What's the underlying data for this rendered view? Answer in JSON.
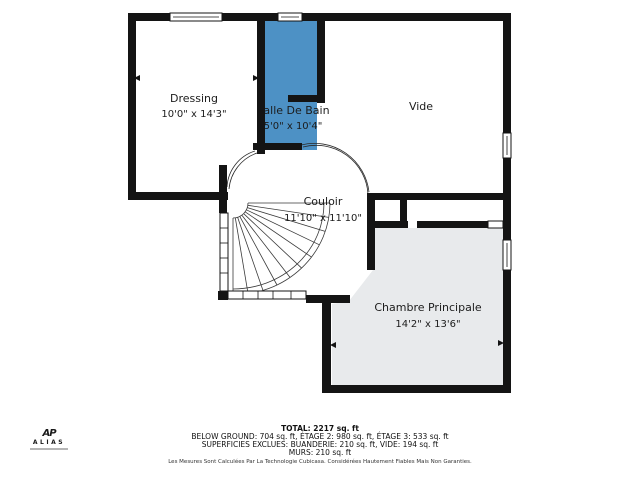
{
  "plan": {
    "rooms": {
      "dressing": {
        "name": "Dressing",
        "dims": "10'0\" x 14'3\""
      },
      "salle_bain": {
        "name": "Salle De Bain",
        "dims": "5'0\" x 10'4\""
      },
      "vide": {
        "name": "Vide",
        "dims": ""
      },
      "couloir": {
        "name": "Couloir",
        "dims": "11'10\" x 11'10\""
      },
      "chambre": {
        "name": "Chambre Principale",
        "dims": "14'2\" x 13'6\""
      }
    },
    "colors": {
      "wall": "#141414",
      "bathroom_fill": "#4d91c5",
      "bedroom_fill": "#e8eaec"
    }
  },
  "summary": {
    "total": "TOTAL: 2217 sq. ft",
    "floors": "BELOW GROUND: 704 sq. ft, ÉTAGE 2: 980 sq. ft, ÉTAGE 3: 533 sq. ft",
    "exclusions": "SUPERFICIES EXCLUES: BUANDERIE: 210 sq. ft, VIDE: 194 sq. ft",
    "walls": "MURS: 210 sq. ft"
  },
  "disclaimer": "Les Mesures Sont Calculées Par La Technologie Cubicasa. Considérées Hautement Fiables Mais Non Garanties.",
  "logo": {
    "monogram": "AP",
    "name": "ALIAS"
  }
}
